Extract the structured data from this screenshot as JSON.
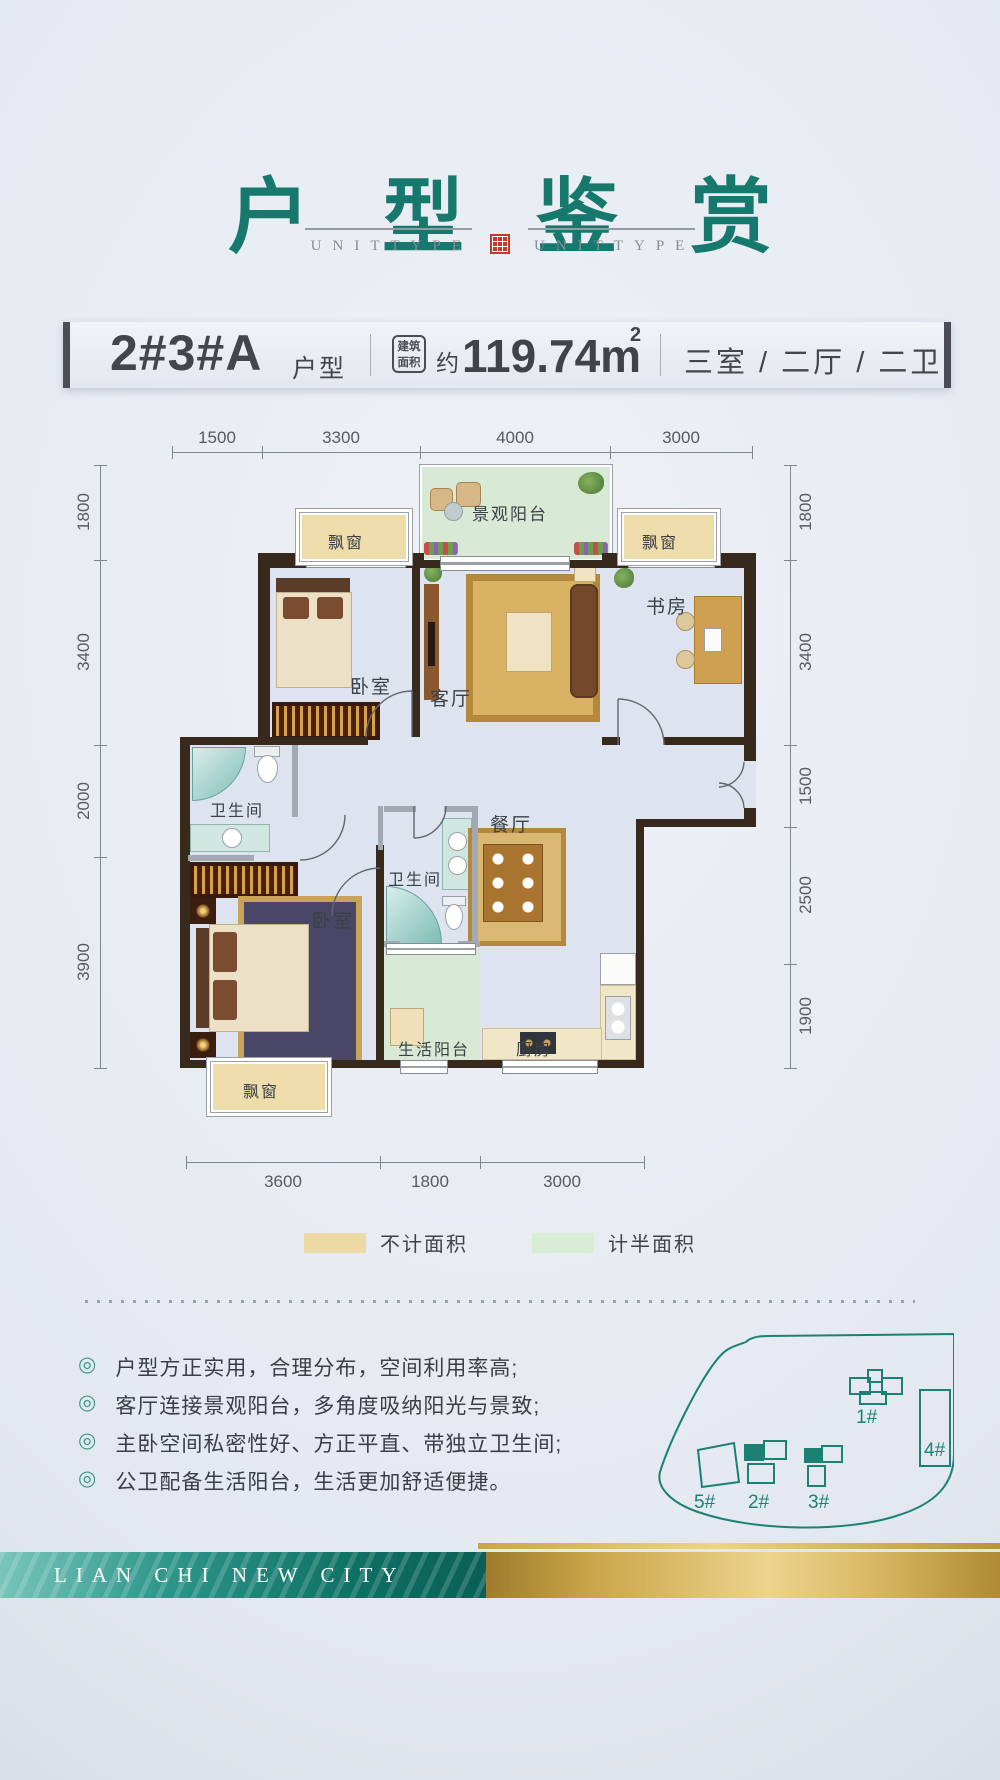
{
  "header": {
    "title": "户型鉴赏",
    "subtitle": "UNITTYPE"
  },
  "unit_bar": {
    "name": "2#3#A",
    "name_suffix": "户型",
    "badge_line1": "建筑",
    "badge_line2": "面积",
    "approx": "约",
    "area_value": "119.74m",
    "area_exponent": "2",
    "layout": "三室 / 二厅 / 二卫"
  },
  "dims": {
    "top": [
      "1500",
      "3300",
      "4000",
      "3000"
    ],
    "left": [
      "1800",
      "3400",
      "2000",
      "3900"
    ],
    "right": [
      "1800",
      "3400",
      "1500",
      "2500",
      "1900"
    ],
    "bottom": [
      "3600",
      "1800",
      "3000"
    ]
  },
  "rooms": {
    "view_balcony": "景观阳台",
    "bay": "飘窗",
    "bedroom": "卧室",
    "living": "客厅",
    "study": "书房",
    "bath": "卫生间",
    "dining": "餐厅",
    "service_balcony": "生活阳台",
    "kitchen": "厨房"
  },
  "legend": {
    "excluded_label": "不计面积",
    "excluded_color": "#ecd9a6",
    "half_label": "计半面积",
    "half_color": "#d9ecd4"
  },
  "features": [
    "户型方正实用，合理分布，空间利用率高;",
    "客厅连接景观阳台，多角度吸纳阳光与景致;",
    "主卧空间私密性好、方正平直、带独立卫生间;",
    "公卫配备生活阳台，生活更加舒适便捷。"
  ],
  "sitemap": {
    "b1": "1#",
    "b2": "2#",
    "b3": "3#",
    "b4": "4#",
    "b5": "5#"
  },
  "footer": {
    "brand": "LIAN CHI NEW CITY"
  }
}
